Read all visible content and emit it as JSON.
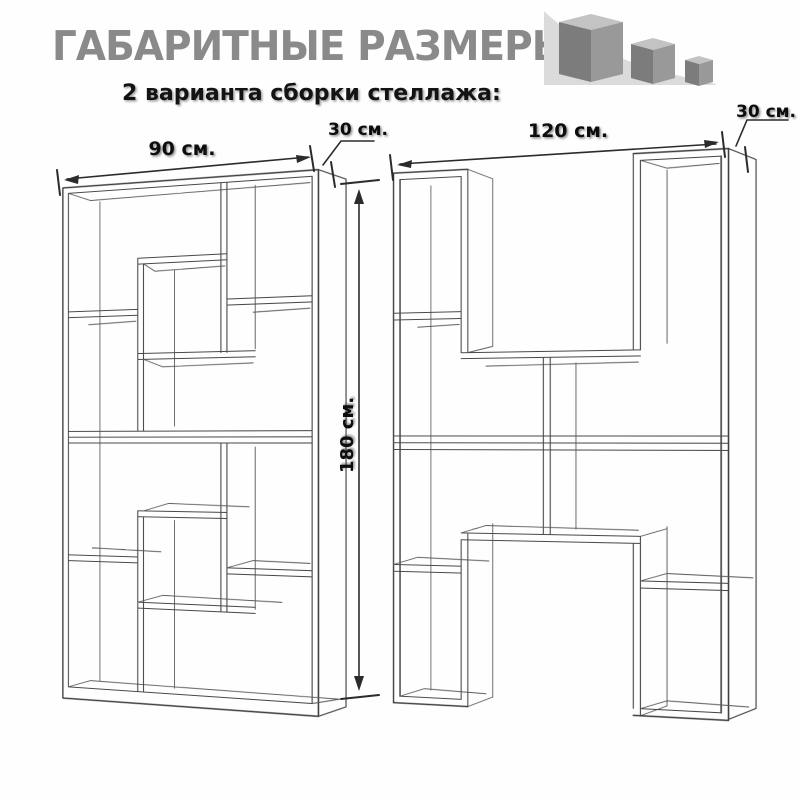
{
  "header": {
    "title": "ГАБАРИТНЫЕ РАЗМЕРЫ",
    "subtitle": "2 варианта сборки стеллажа:"
  },
  "logo": {
    "icon": "three-cubes-logo",
    "triangle_color": "#dbdbdb",
    "cube_top_color": "#c3c3c3",
    "cube_left_color": "#7c7c7c",
    "cube_right_color": "#999999"
  },
  "variants": [
    {
      "name": "стеллаж 90 см",
      "width_label": "90 см.",
      "depth_label": "30 см.",
      "height_label": "180 см."
    },
    {
      "name": "стеллаж 120 см",
      "width_label": "120 см.",
      "depth_label": "30 см."
    }
  ],
  "style": {
    "line_color": "#3f3f3f",
    "title_color": "#8a8a8a",
    "text_color": "#0d0d0d",
    "background": "#fefefe"
  }
}
